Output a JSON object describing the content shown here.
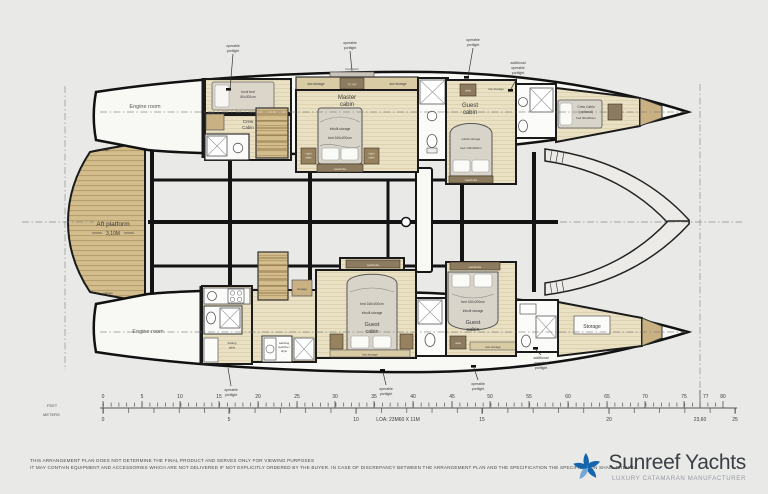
{
  "plan": {
    "engine_room": "Engine room",
    "aft_platform": {
      "title": "Aft platform",
      "dimension": "3,10M"
    },
    "railings": "railings"
  },
  "callouts": {
    "operable": {
      "l1": "operable",
      "l2": "portlight"
    },
    "additional": {
      "l1": "additional",
      "l2": "operable",
      "l3": "portlight"
    }
  },
  "rooms": {
    "crew_aft": {
      "name1": "Crew",
      "name2": "Cabin",
      "bunk1": "bunk bed",
      "bunk2": "80x200cm"
    },
    "master": {
      "name1": "Master",
      "name2": "cabin",
      "bed": "bed 160x200cm",
      "inbuilt": "inbuilt storage",
      "low_storage": "low storage",
      "tv": "TV 40\"",
      "hatch": "fixed hatch",
      "wardrobe": "wardrobe",
      "night1": "night",
      "night2": "table"
    },
    "guest_top": {
      "name1": "Guest",
      "name2": "cabin",
      "bed": "bed 140x200cm",
      "inbuilt": "inbuilt storage",
      "low_storage": "low storage",
      "desk": "desk",
      "wardrobe": "wardrobe"
    },
    "crew_bow": {
      "name1": "Crew Cabin",
      "name2": "(optional)",
      "bed": "bed 90x200cm"
    },
    "guest_bottom_aft": {
      "name1": "Guest",
      "name2": "cabin",
      "bed": "bed 160x200cm",
      "inbuilt": "inbuilt storage",
      "low_storage": "low storage",
      "wardrobe": "wardrobe"
    },
    "guest_bottom_fwd": {
      "name1": "Guest",
      "name2": "cabin",
      "bed": "bed 160x200cm",
      "inbuilt": "inbuilt storage",
      "low_storage": "low storage",
      "desk": "desk",
      "wardrobe": "wardrobe"
    },
    "storage_bow": "Storage",
    "storage_small": "storage",
    "washing_machine": {
      "l1": "washing",
      "l2": "machine /",
      "l3": "dryer"
    },
    "folding_table": {
      "l1": "folding",
      "l2": "table"
    }
  },
  "ruler": {
    "feet_label": "FEET",
    "meters_label": "METERS",
    "feet_ticks": [
      "0",
      "5",
      "10",
      "15",
      "20",
      "25",
      "30",
      "35",
      "40",
      "45",
      "50",
      "55",
      "60",
      "65",
      "70",
      "75",
      "80"
    ],
    "loa_feet": "77",
    "meter_ticks": [
      "0",
      "5",
      "10",
      "15",
      "20",
      "25"
    ],
    "loa_meters": "23,60",
    "loa_label": "LOA: 23M60 X 11M"
  },
  "footer": {
    "line1": "THIS ARRANGEMENT PLAN DOES NOT DETERMINE THE FINAL PRODUCT AND SERVES ONLY FOR VIEWING PURPOSES",
    "line2": "IT MAY CONTAIN EQUIPMENT AND ACCESSORIES WHICH ARE NOT DELIVERED IF NOT EXPLICITLY ORDERED BY THE BUYER. IN CASE OF DISCREPANCY BETWEEN THE ARRANGEMENT PLAN AND THE SPECIFICATION THE SPECIFICATION SHALL PREVAIL."
  },
  "logo": {
    "name": "Sunreef Yachts",
    "tagline": "LUXURY CATAMARAN MANUFACTURER"
  },
  "colors": {
    "logo_blue": "#1565ae",
    "teak": "#d3bd8c",
    "pale_wood": "#eae1c4",
    "dark_wood": "#8d7b5f",
    "background": "#e9e9e7"
  }
}
